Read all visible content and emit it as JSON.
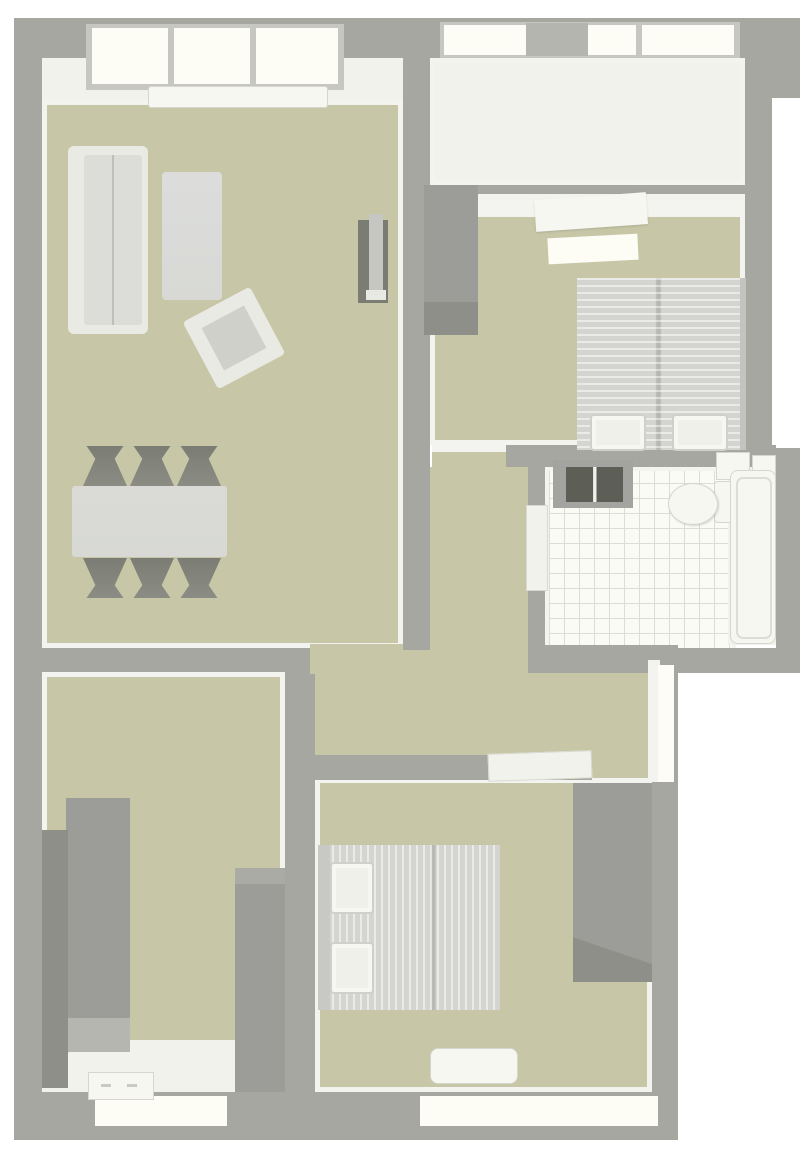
{
  "scene": {
    "type": "3d-floor-plan-top-view",
    "description": "Rendered top-down 3D floor plan of an apartment, no visible text labels",
    "rooms": [
      {
        "id": "living-room",
        "position": "top-left",
        "furniture": [
          "sofa",
          "coffee-table",
          "armchair",
          "tv-unit",
          "dining-table",
          "dining-chairs-x6",
          "bay-window-3-panes",
          "window-sill"
        ]
      },
      {
        "id": "balcony-white-floor",
        "position": "top-right-upper",
        "furniture": [
          "window-band-3-panes",
          "open-gray-sash"
        ]
      },
      {
        "id": "bedroom-1",
        "position": "top-right",
        "furniture": [
          "double-bed-2-pillows",
          "wardrobe",
          "ceiling-light-panel-x2",
          "door-to-corridor"
        ]
      },
      {
        "id": "bathroom",
        "position": "middle-right",
        "furniture": [
          "tiled-floor",
          "double-basin-vanity",
          "toilet",
          "cistern-boxes",
          "bathtub",
          "door-to-corridor"
        ]
      },
      {
        "id": "hallway-corridor",
        "position": "center",
        "furniture": [
          "open-door-leaf",
          "east-wall-window"
        ]
      },
      {
        "id": "bedroom-2",
        "position": "bottom-right",
        "furniture": [
          "double-bed-2-pillows",
          "wardrobe",
          "window-bench",
          "south-window"
        ]
      },
      {
        "id": "bedroom-3-entry",
        "position": "bottom-left",
        "furniture": [
          "tall-wardrobe-left-a",
          "tall-wardrobe-left-b",
          "tall-wardrobe-right",
          "white-entry-floor",
          "small-cabinet",
          "south-window"
        ]
      }
    ]
  },
  "palette": {
    "background": "#ffffff",
    "wall": "#a6a7a0",
    "wall_shadow": "#97objectively",
    "wall_inner": "#f3f4ef",
    "floor": "#c7c6a7",
    "white_floor": "#f1f2ec",
    "tile": "#fbfbf6",
    "tile_line": "#dcddd4",
    "window_glass": "#fdfdf5",
    "window_frame": "#c6c7c0",
    "window_sash": "#b4b5ae",
    "furniture_light": "#d8d9d5",
    "furniture_gray": "#9c9d98",
    "furniture_gray_dark": "#8e8f89",
    "furniture_dark": "#7b7d75",
    "basin_dark": "#5d5f56",
    "fixture_white": "#f6f7f1",
    "sofa_white": "#e9eae4",
    "cushion": "#dcddd8"
  }
}
